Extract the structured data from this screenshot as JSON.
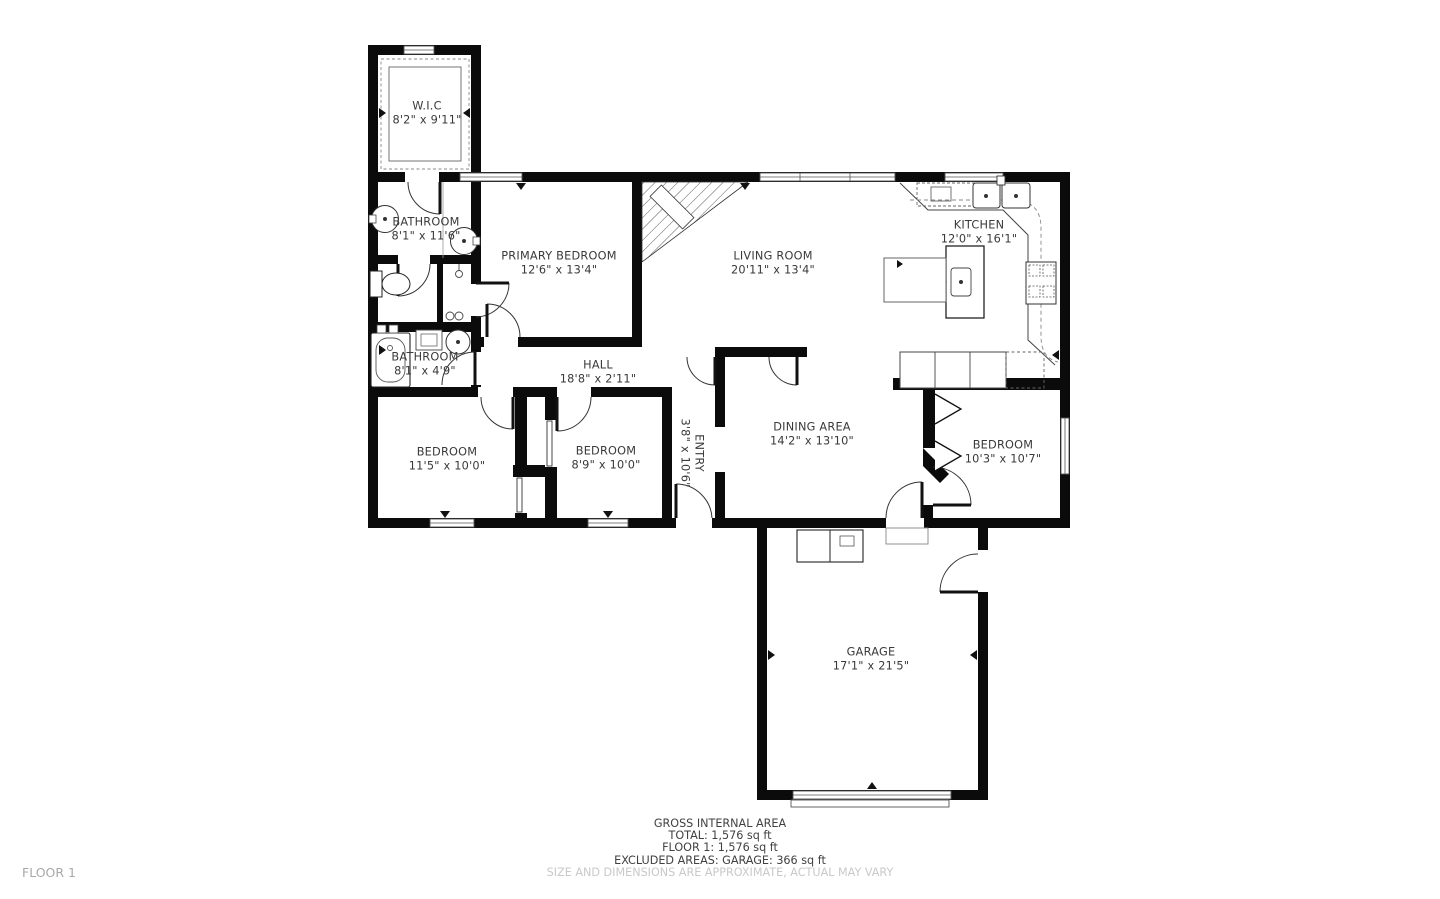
{
  "floor_plan": {
    "rooms": [
      {
        "name": "W.I.C",
        "dims": "8'2\" x 9'11\""
      },
      {
        "name": "BATHROOM",
        "dims": "8'1\" x 11'6\""
      },
      {
        "name": "PRIMARY BEDROOM",
        "dims": "12'6\" x 13'4\""
      },
      {
        "name": "LIVING ROOM",
        "dims": "20'11\" x 13'4\""
      },
      {
        "name": "KITCHEN",
        "dims": "12'0\" x 16'1\""
      },
      {
        "name": "BATHROOM",
        "dims": "8'1\" x 4'9\""
      },
      {
        "name": "HALL",
        "dims": "18'8\" x 2'11\""
      },
      {
        "name": "BEDROOM",
        "dims": "11'5\" x 10'0\""
      },
      {
        "name": "BEDROOM",
        "dims": "8'9\" x 10'0\""
      },
      {
        "name": "ENTRY",
        "dims": "3'8\" x 10'6\""
      },
      {
        "name": "DINING AREA",
        "dims": "14'2\" x 13'10\""
      },
      {
        "name": "BEDROOM",
        "dims": "10'3\" x 10'7\""
      },
      {
        "name": "GARAGE",
        "dims": "17'1\" x 21'5\""
      }
    ],
    "summary": {
      "line1": "GROSS INTERNAL AREA",
      "line2": "TOTAL: 1,576 sq ft",
      "line3": "FLOOR 1: 1,576 sq ft",
      "line4": "EXCLUDED AREAS: GARAGE: 366 sq ft",
      "disclaimer": "SIZE AND DIMENSIONS ARE APPROXIMATE, ACTUAL MAY VARY"
    },
    "footer": {
      "floor_label": "FLOOR 1"
    }
  }
}
